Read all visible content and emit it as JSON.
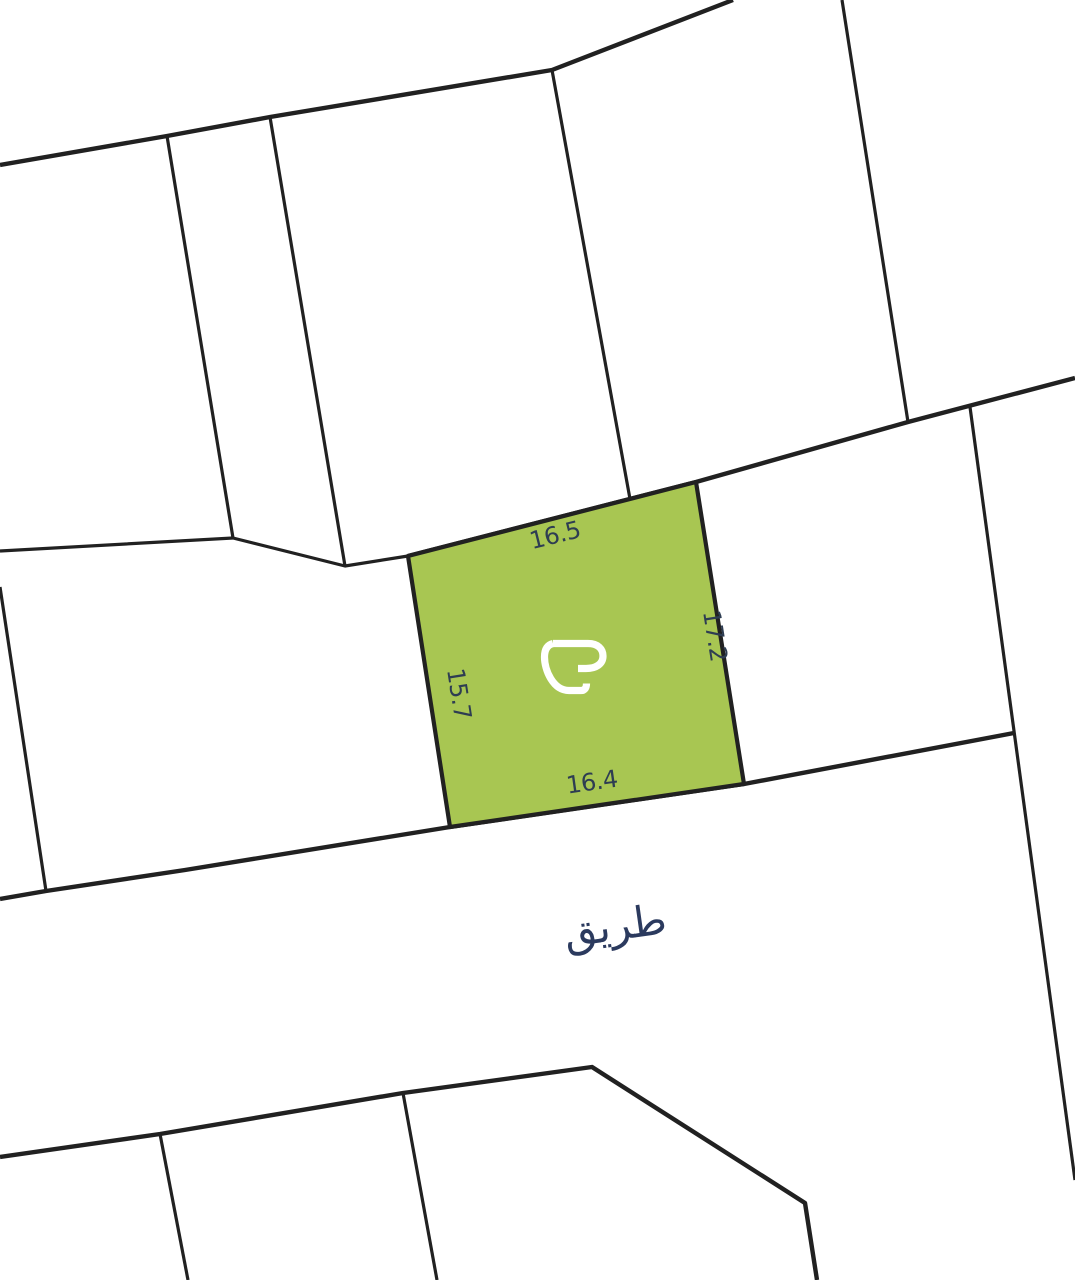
{
  "map": {
    "parcel": {
      "fill": "#a8c652",
      "polygon": [
        [
          408,
          556
        ],
        [
          696,
          482
        ],
        [
          744,
          784
        ],
        [
          450,
          827
        ]
      ],
      "dimensions": {
        "top": "16.5",
        "right": "17.2",
        "bottom": "16.4",
        "left": "15.7"
      }
    },
    "road": {
      "label": "طريق"
    },
    "colors": {
      "line": "#212121",
      "dimension_label": "#2e3d52",
      "road_label": "#2b3a5e",
      "background": "#ffffff"
    },
    "boundaries": {
      "thick": [
        [
          [
            0,
            165
          ],
          [
            167,
            136
          ],
          [
            270,
            117
          ],
          [
            552,
            70
          ],
          [
            733,
            0
          ]
        ],
        [
          [
            408,
            556
          ],
          [
            696,
            482
          ],
          [
            908,
            422
          ],
          [
            1075,
            378
          ]
        ],
        [
          [
            0,
            899
          ],
          [
            46,
            891
          ],
          [
            185,
            870
          ],
          [
            450,
            827
          ],
          [
            744,
            784
          ],
          [
            1014,
            733
          ]
        ],
        [
          [
            0,
            1157
          ],
          [
            160,
            1134
          ],
          [
            403,
            1093
          ],
          [
            592,
            1067
          ],
          [
            805,
            1203
          ],
          [
            817,
            1280
          ]
        ]
      ],
      "thin": [
        [
          [
            167,
            136
          ],
          [
            233,
            538
          ]
        ],
        [
          [
            270,
            117
          ],
          [
            345,
            566
          ]
        ],
        [
          [
            552,
            70
          ],
          [
            630,
            499
          ]
        ],
        [
          [
            0,
            551
          ],
          [
            233,
            538
          ],
          [
            345,
            566
          ],
          [
            408,
            556
          ]
        ],
        [
          [
            842,
            0
          ],
          [
            908,
            422
          ]
        ],
        [
          [
            970,
            407
          ],
          [
            1075,
            1180
          ]
        ],
        [
          [
            0,
            587
          ],
          [
            46,
            891
          ]
        ],
        [
          [
            160,
            1134
          ],
          [
            188,
            1280
          ]
        ],
        [
          [
            403,
            1093
          ],
          [
            437,
            1280
          ]
        ]
      ]
    },
    "logo": "brand-mark"
  }
}
